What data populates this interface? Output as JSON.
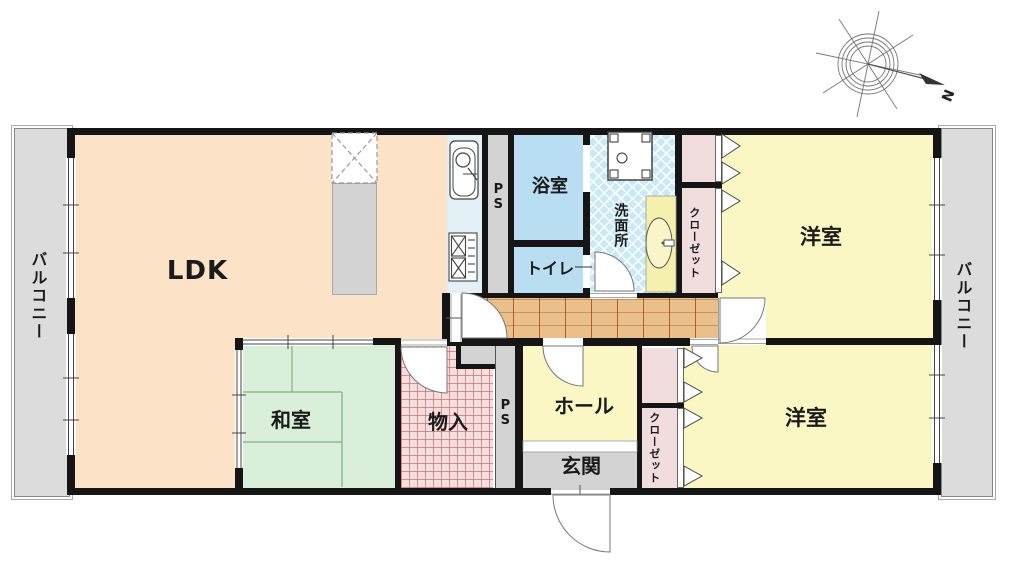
{
  "rooms": {
    "ldk": {
      "label": "LDK"
    },
    "washitsu": {
      "label": "和室"
    },
    "monoire": {
      "label": "物入"
    },
    "hall": {
      "label": "ホール"
    },
    "genkan": {
      "label": "玄関"
    },
    "bath": {
      "label": "浴室"
    },
    "toilet": {
      "label": "トイレ"
    },
    "washroom": {
      "label": "洗面所"
    },
    "western_top": {
      "label": "洋室"
    },
    "western_bottom": {
      "label": "洋室"
    },
    "closet_top": {
      "label": "クローゼット"
    },
    "closet_bottom": {
      "label": "クローゼット"
    },
    "ps_top": {
      "label": "PS"
    },
    "ps_bottom": {
      "label": "PS"
    },
    "balcony_left": {
      "label": "バルコニー"
    },
    "balcony_right": {
      "label": "バルコニー"
    }
  },
  "compass": {
    "north_label": "N"
  },
  "colors": {
    "wall": "#151515",
    "ldk": "#fce3c7",
    "tatami_room": "#d9efd9",
    "western_room": "#fbf7c5",
    "bath": "#b9ddf1",
    "washroom": "#c9e9f6",
    "closet": "#f1dddd",
    "corridor_wood": "#e9bf8b",
    "storage": "#f7dede",
    "service_gray": "#d3d3d3",
    "balcony": "#dcdcdc",
    "vanity": "#f6f0ae"
  }
}
